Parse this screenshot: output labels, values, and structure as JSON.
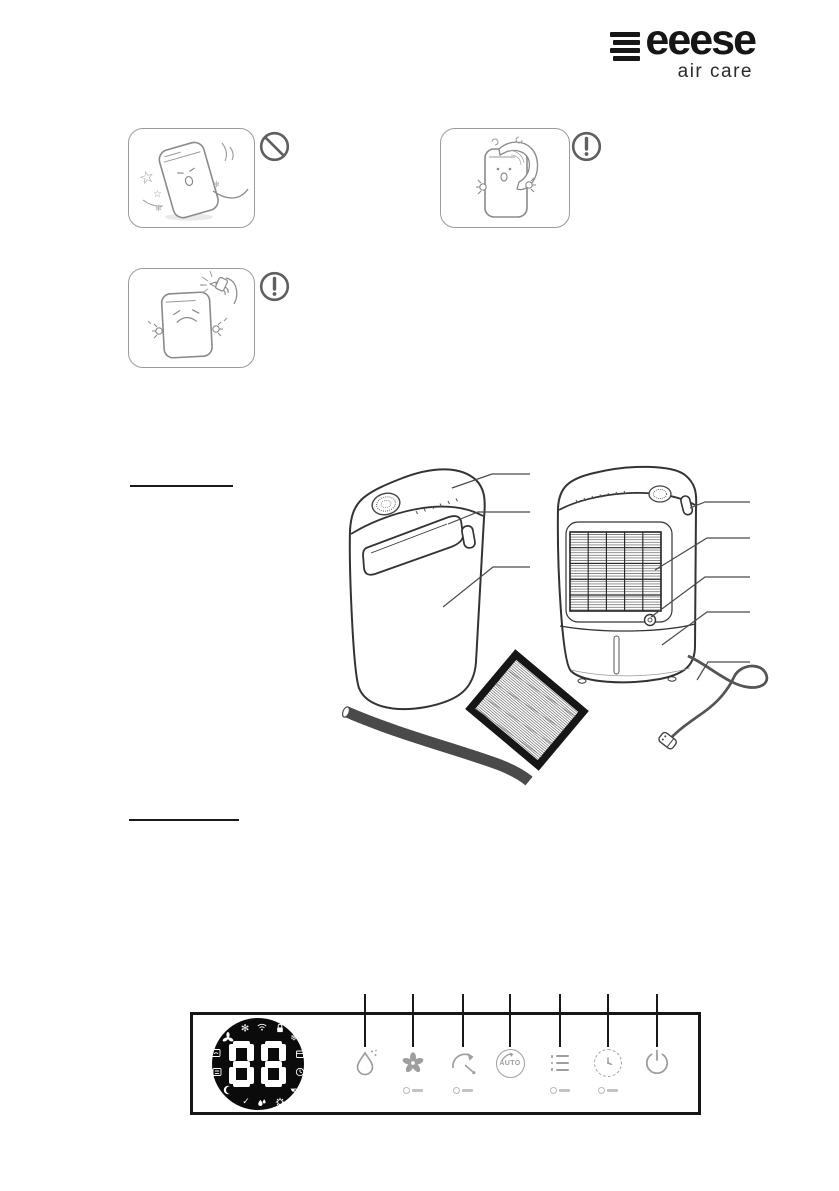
{
  "page": {
    "background": "#ffffff",
    "width": 839,
    "height": 1191
  },
  "logo": {
    "brand": "eeese",
    "subtitle": "air care",
    "color": "#161616"
  },
  "glyphs": {
    "star_large": "☆",
    "star_small": "☆",
    "sparkle": "✻",
    "snowflake": "❄",
    "check": "✓"
  },
  "warnings": [
    {
      "name": "do-not-tip-over",
      "badge": "prohibition"
    },
    {
      "name": "do-not-cover-with-cloth",
      "badge": "exclamation"
    },
    {
      "name": "do-not-spray-liquids",
      "badge": "exclamation"
    }
  ],
  "sections": {
    "heading_rules": 2
  },
  "diagram": {
    "views": [
      "front-view",
      "back-view"
    ],
    "parts": [
      "control-panel",
      "air-outlet",
      "housing",
      "handle",
      "air-inlet-grille",
      "drain-outlet",
      "water-tank",
      "power-cord",
      "drain-hose",
      "filter"
    ],
    "callouts": {
      "left": 3,
      "right": 5
    }
  },
  "control_panel": {
    "display": {
      "value": "88",
      "icons": [
        "fan-high-icon",
        "wifi-icon",
        "child-lock-icon",
        "fan-low-icon",
        "defrost-icon",
        "continuous-drain-icon",
        "tank-full-icon",
        "humidity-box-icon",
        "clock-icon",
        "sleep-moon-icon",
        "drain-tap-icon",
        "check-icon",
        "water-drops-icon",
        "gear-icon"
      ]
    },
    "buttons": [
      {
        "name": "humidity",
        "icon": "humidity-drop-icon"
      },
      {
        "name": "fan-speed",
        "icon": "fan-icon",
        "has_sublabel": true
      },
      {
        "name": "swing",
        "icon": "swing-arrow-icon",
        "has_sublabel": true
      },
      {
        "name": "auto",
        "icon": "auto-circle-icon",
        "label": "AUTO"
      },
      {
        "name": "mode-list",
        "icon": "list-icon",
        "has_sublabel": true
      },
      {
        "name": "timer",
        "icon": "timer-clock-icon",
        "has_sublabel": true
      },
      {
        "name": "power",
        "icon": "power-icon"
      }
    ]
  }
}
